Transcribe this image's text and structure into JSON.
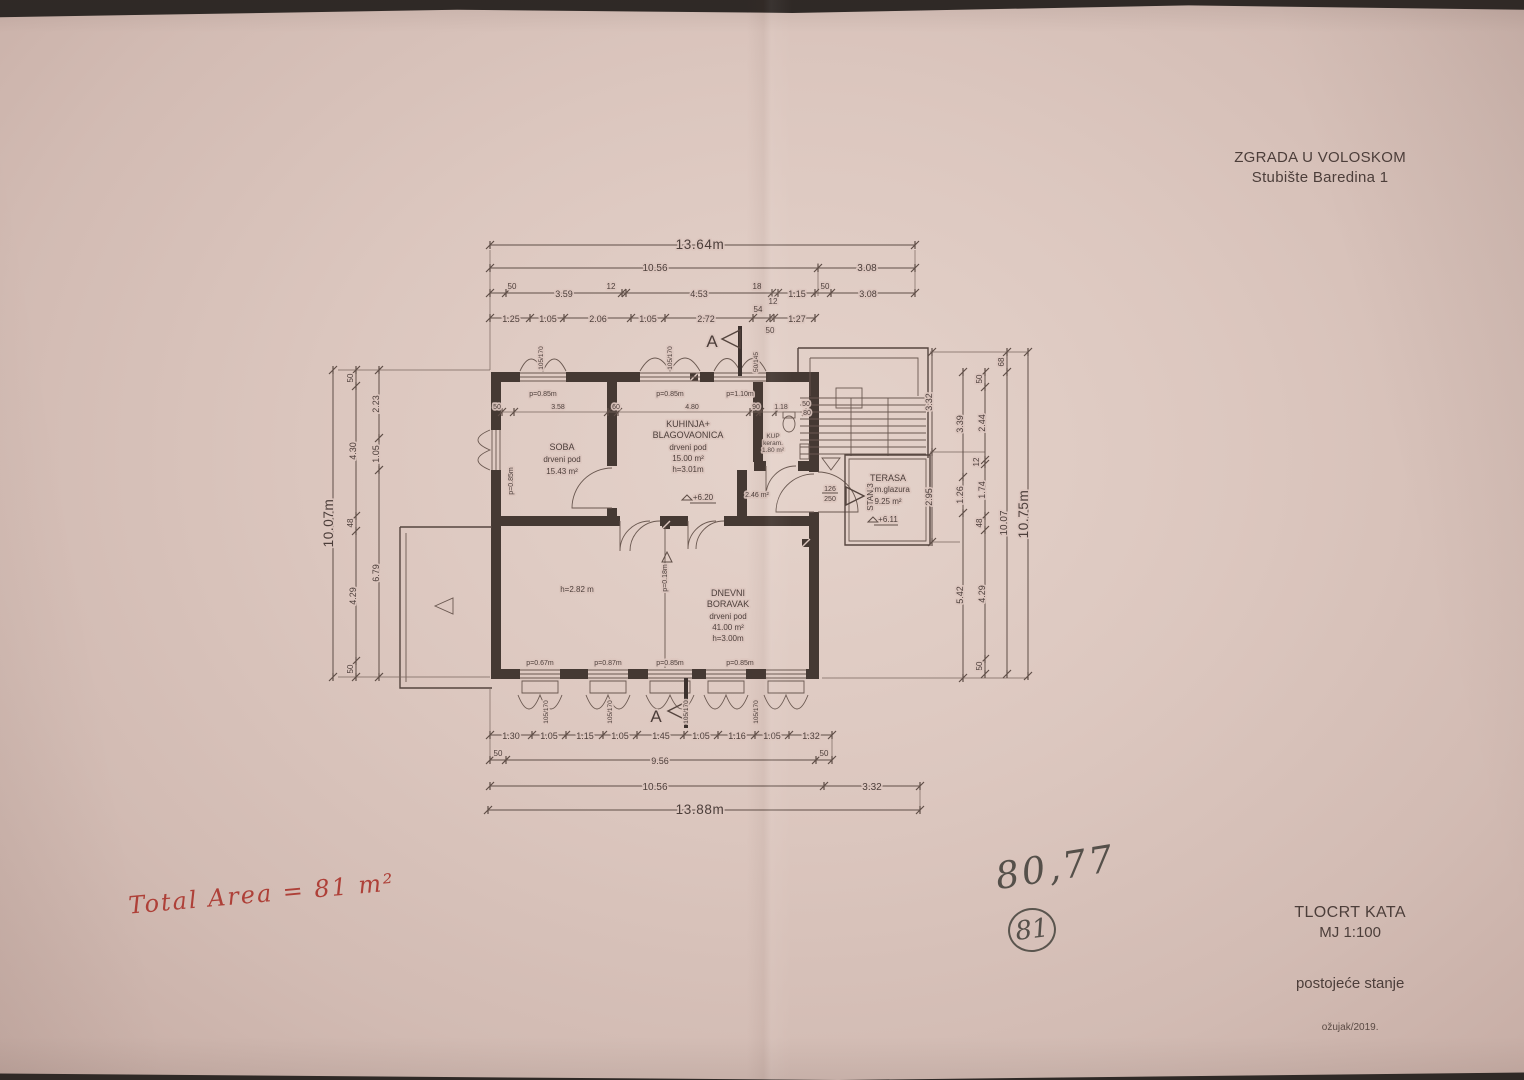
{
  "header": {
    "project": "ZGRADA U VOLOSKOM",
    "address": "Stubište Baredina 1"
  },
  "titleblock": {
    "drawing": "TLOCRT KATA",
    "scale": "MJ 1:100",
    "status": "postojeće stanje",
    "date": "ožujak/2019."
  },
  "handwriting": {
    "red_note": "Total Area = 81 m²",
    "pencil_sum": "80,77",
    "pencil_circled": "81"
  },
  "section": {
    "label": "A"
  },
  "rooms": {
    "soba": {
      "name": "SOBA",
      "floor": "drveni pod",
      "area": "15.43 m²"
    },
    "kuhinja": {
      "name1": "KUHINJA+",
      "name2": "BLAGOVAONICA",
      "floor": "drveni pod",
      "area": "15.00 m²",
      "height": "h=3.01m",
      "level": "+6.20"
    },
    "dnevni": {
      "name1": "DNEVNI",
      "name2": "BORAVAK",
      "floor": "drveni pod",
      "area": "41.00 m²",
      "height": "h=3.00m",
      "height2": "h=2.82 m",
      "door": "p=0.18m"
    },
    "terasa": {
      "name": "TERASA",
      "floor": "cem.glazura",
      "area": "9.25 m²",
      "level": "+6.11"
    },
    "kupaonica": {
      "name": "KUP",
      "floor": "keram.",
      "area": "1.80 m²"
    },
    "hodnik": {
      "area": "2.46 m²"
    },
    "entrance": {
      "apartment": "STAN 3",
      "door_width": "126",
      "door_height": "250"
    }
  },
  "windows": {
    "top": [
      "p=0.85m",
      "p=0.85m",
      "p=1.10m"
    ],
    "left": "p=0.85m",
    "bottom": [
      "p=0.67m",
      "p=0.87m",
      "p=0.85m",
      "p=0.85m"
    ],
    "size_tall": "105/170",
    "size_small": "50/145"
  },
  "interior_dims": {
    "row": [
      "50",
      "3.58",
      "60",
      "4.80",
      "90",
      "1.18",
      "50"
    ],
    "stair_width": "80"
  },
  "dims": {
    "top": {
      "total": "13.64m",
      "row2": [
        "10.56",
        "3.08"
      ],
      "row3": [
        "50",
        "3.59",
        "12",
        "4.53",
        "18",
        "1.15",
        "50",
        "3.08"
      ],
      "row4": [
        "1.25",
        "1.05",
        "2.06",
        "1.05",
        "2.72",
        "54",
        "12",
        "1.27"
      ],
      "row4b": "50"
    },
    "bottom": {
      "row1": [
        "1.30",
        "1.05",
        "1.15",
        "1.05",
        "1.45",
        "1.05",
        "1.16",
        "1.05",
        "1.32"
      ],
      "row2": [
        "50",
        "9.56",
        "50"
      ],
      "row3": [
        "10.56",
        "3.32"
      ],
      "total": "13.88m"
    },
    "left": {
      "total": "10.07m",
      "col2": [
        "50",
        "4.30",
        "48",
        "4.29",
        "50"
      ],
      "col3": [
        "2.23",
        "1.05",
        "6.79"
      ]
    },
    "right": {
      "col1": [
        "3.32",
        "2.95"
      ],
      "col2": [
        "3.39",
        "1.26",
        "5.42"
      ],
      "col3": [
        "50",
        "2.44",
        "12",
        "1.74",
        "48",
        "4.29",
        "50"
      ],
      "col4": [
        "68",
        "10.07"
      ],
      "total": "10.75m"
    }
  },
  "colors": {
    "paper": "#d9c3bb",
    "ink": "#4c3e3a",
    "red": "#ae4038",
    "pencil": "#55504a"
  }
}
